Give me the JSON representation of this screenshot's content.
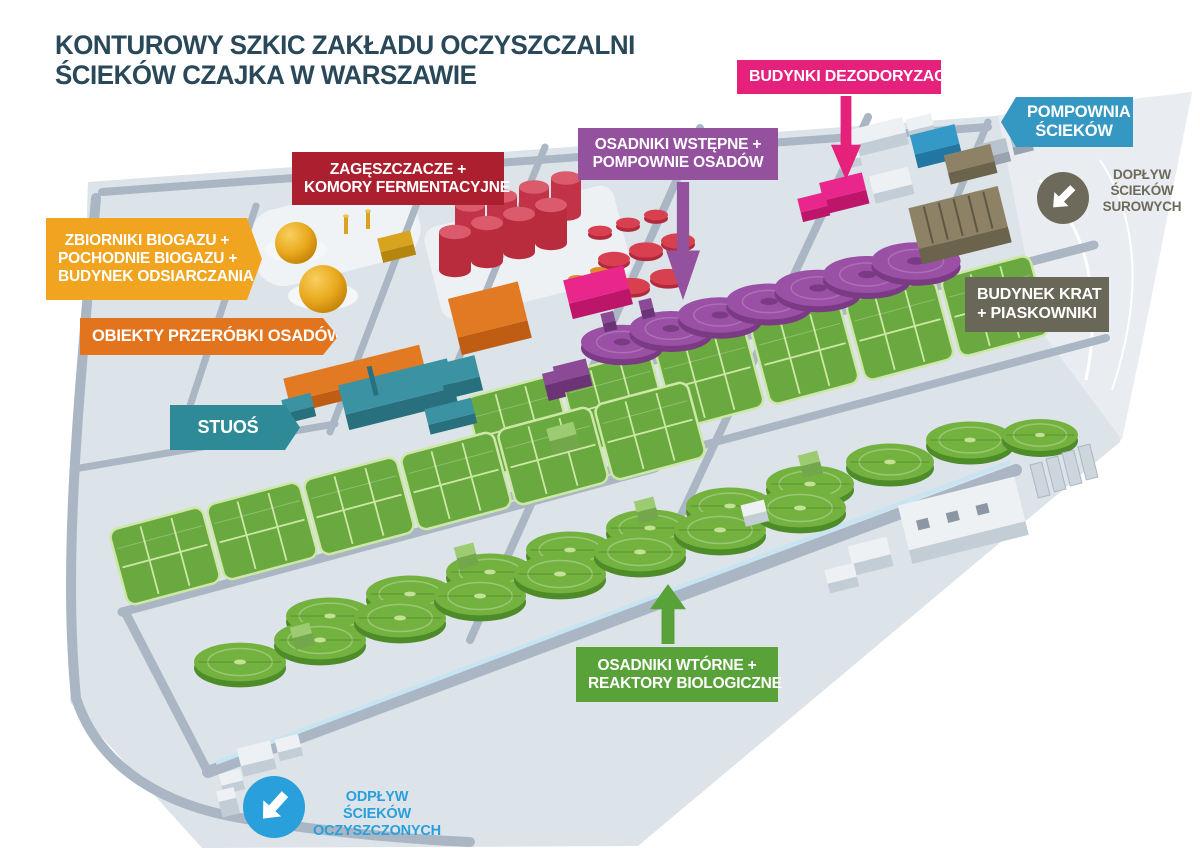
{
  "title": {
    "line1": "KONTUROWY SZKIC ZAKŁADU OCZYSZCZALNI",
    "line2": "ŚCIEKÓW CZAJKA W WARSZAWIE",
    "color": "#29485a"
  },
  "callouts": {
    "budynki_dezodoryzacji": {
      "label": "BUDYNKI DEZODORYZACJI",
      "color": "#e6217c"
    },
    "pompownia_sciekow": {
      "line1": "POMPOWNIA",
      "line2": "ŚCIEKÓW",
      "color": "#3598c3"
    },
    "doplyw_sciekow_surowych": {
      "line1": "DOPŁYW",
      "line2": "ŚCIEKÓW",
      "line3": "SUROWYCH",
      "color": "#6e6a5b",
      "icon": "arrow-inflow-icon"
    },
    "zageszczacze_komory": {
      "line1": "ZAGĘSZCZACZE +",
      "line2": "KOMORY FERMENTACYJNE",
      "color": "#ac1f2e"
    },
    "osadniki_wstepne": {
      "line1": "OSADNIKI WSTĘPNE +",
      "line2": "POMPOWNIE OSADÓW",
      "color": "#94519e"
    },
    "zbiorniki_biogazu": {
      "line1": "ZBIORNIKI BIOGAZU +",
      "line2": "POCHODNIE BIOGAZU +",
      "line3": "BUDYNEK ODSIARCZANIA",
      "color": "#f1a41f"
    },
    "obiekty_przerobki": {
      "label": "OBIEKTY PRZERÓBKI OSADÓW",
      "color": "#e2741e"
    },
    "stuos": {
      "label": "STUOŚ",
      "color": "#2e8a97"
    },
    "budynek_krat": {
      "line1": "BUDYNEK KRAT",
      "line2": "+ PIASKOWNIKI",
      "color": "#696758"
    },
    "osadniki_wtorne": {
      "line1": "OSADNIKI WTÓRNE +",
      "line2": "REAKTORY BIOLOGICZNE",
      "color": "#59a23a"
    },
    "odplyw_sciekow": {
      "line1": "ODPŁYW ŚCIEKÓW",
      "line2": "OCZYSZCZONYCH",
      "color": "#29a0dc",
      "icon": "arrow-outflow-icon"
    }
  },
  "map_colors": {
    "ground": "#dce3e9",
    "ground_light": "#e9edf1",
    "road": "#aab6c3",
    "treated_water_channel": "#c6e4f2",
    "bio_reactor_green": "#6aa93f",
    "clarifier_green": "#74b23f",
    "primary_tank_purple": "#9a50a4",
    "digester_red": "#c93a4f",
    "biogas_yellow": "#e9a91e",
    "sludge_building_orange": "#e27a24",
    "stuos_teal": "#3a92a2",
    "deodorization_pink": "#e8268b",
    "pumping_station_blue": "#3599c8",
    "screens_building_brown": "#8d8266",
    "generic_building_white": "#eef1f4"
  }
}
